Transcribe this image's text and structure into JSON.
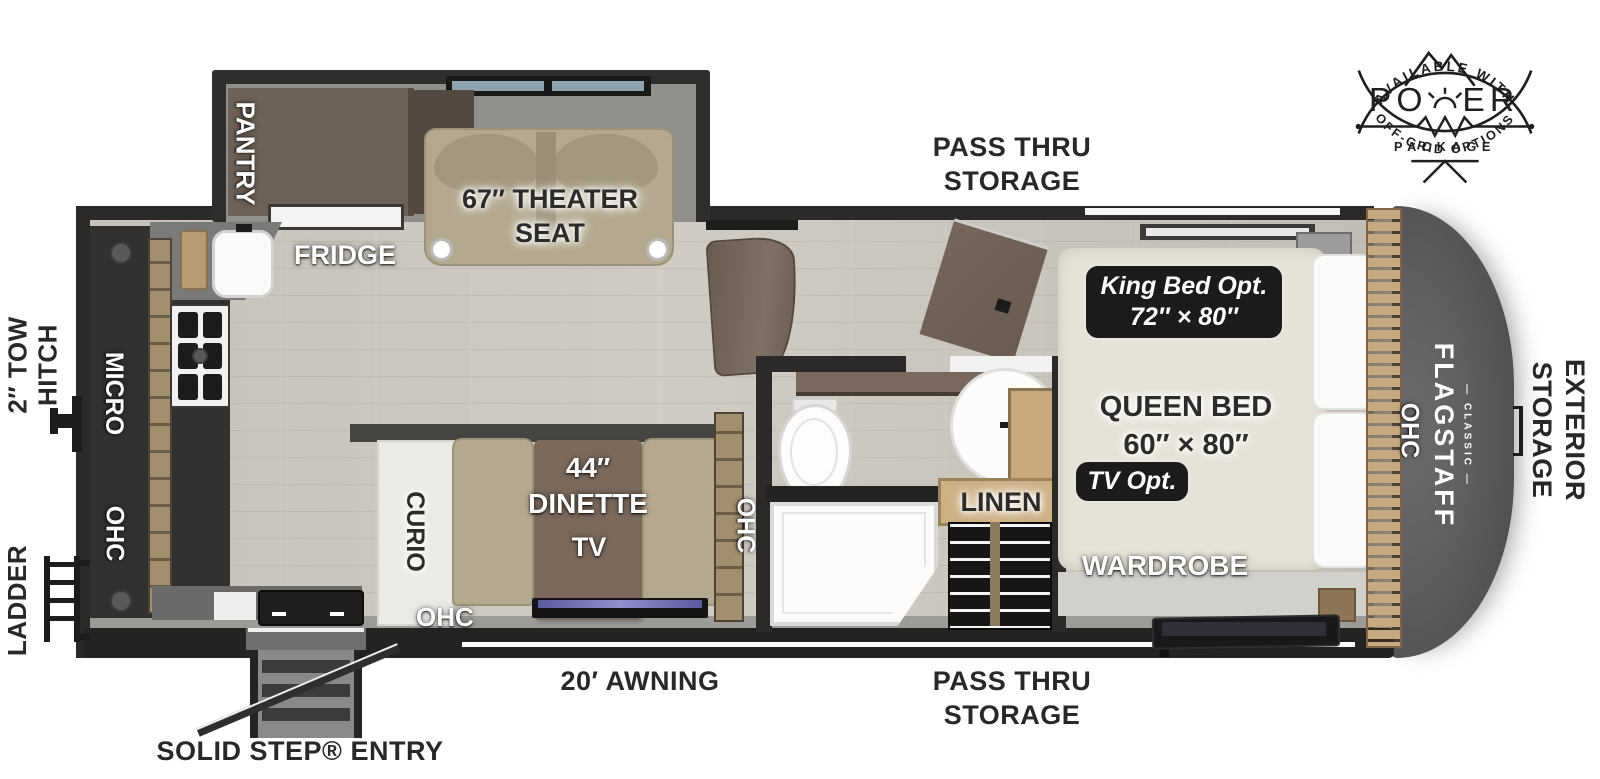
{
  "badge": {
    "arc_top": "AVAILABLE WITH",
    "word_main_left": "PO",
    "word_main_right": "ER",
    "word_sub": "PACKAGE",
    "arc_bottom": "OFF-GRID OPTIONS"
  },
  "exterior": {
    "pass_thru_top": {
      "line1": "PASS THRU",
      "line2": "STORAGE"
    },
    "pass_thru_bottom": {
      "line1": "PASS THRU",
      "line2": "STORAGE"
    },
    "awning": "20′ AWNING",
    "solid_step": "SOLID STEP® ENTRY",
    "tow_hitch": {
      "line1": "2″ TOW",
      "line2": "HITCH"
    },
    "ladder": "LADDER",
    "exterior_storage": {
      "line1": "EXTERIOR",
      "line2": "STORAGE"
    }
  },
  "interior": {
    "pantry": "PANTRY",
    "fridge": "FRIDGE",
    "theater_seat": {
      "line1": "67″ THEATER",
      "line2": "SEAT"
    },
    "micro": "MICRO",
    "ohc_kitchen": "OHC",
    "curio": "CURIO",
    "dinette": {
      "line1": "44″",
      "line2": "DINETTE"
    },
    "tv": "TV",
    "ohc_dinette_bottom": "OHC",
    "ohc_dinette_side": "OHC",
    "linen": "LINEN",
    "wardrobe": "WARDROBE",
    "queen_bed": {
      "line1": "QUEEN BED",
      "line2": "60″ × 80″"
    },
    "king_bed_opt": {
      "line1": "King Bed Opt.",
      "line2": "72″ × 80″"
    },
    "tv_opt": "TV Opt.",
    "ohc_front": "OHC"
  },
  "brand": {
    "name": "FLAGSTAFF",
    "series": "— CLASSIC —"
  },
  "colors": {
    "wall": "#2b2a28",
    "floor_wood": "#c9c5bd",
    "badge_ink": "#1f1f1f",
    "option_pill": "#1b1b1b",
    "front_cap": "#57575a",
    "seat_tan": "#b4a88f",
    "cabinet_brown": "#6e6156"
  }
}
